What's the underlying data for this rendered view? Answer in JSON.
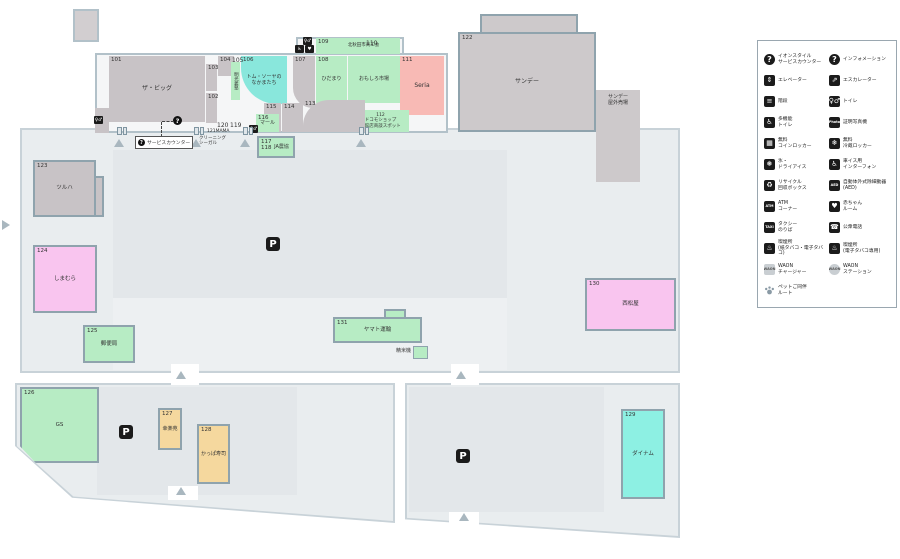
{
  "colors": {
    "parcel": "#e9edef",
    "parking_lot": "#e3e7ea",
    "building_wall": "#b2c1c9",
    "mint": "#b7ecc4",
    "cyan": "#89e7dc",
    "salmon": "#f8bab5",
    "pink": "#f9c5ef",
    "tan": "#f5d89e",
    "gray": "#cdc9cb",
    "icon_black": "#1b1b1b"
  },
  "map": {
    "service_counter": {
      "icon": "?",
      "label": "サービスカウンター"
    },
    "stores": [
      {
        "num": "101",
        "name": "ザ・ビッグ",
        "color": "graystore",
        "x": 109,
        "y": 56,
        "w": 96,
        "h": 66,
        "name_size": 6
      },
      {
        "num": "104",
        "color": "graystore",
        "x": 218,
        "y": 56,
        "w": 16,
        "h": 20
      },
      {
        "num": "103",
        "color": "graystore",
        "x": 206,
        "y": 64,
        "w": 11,
        "h": 27
      },
      {
        "num": "102",
        "color": "graystore",
        "x": 206,
        "y": 93,
        "w": 11,
        "h": 30
      },
      {
        "name": "明光義塾",
        "color": "mint",
        "x": 231,
        "y": 62,
        "w": 9,
        "h": 38,
        "vertical": true,
        "name_size": 4.5
      },
      {
        "num": "106",
        "name": "トム・ソーヤの\nなかまたち",
        "color": "cyan",
        "x": 241,
        "y": 56,
        "w": 46,
        "h": 48,
        "r": "0 0 0 36px",
        "name_size": 5
      },
      {
        "num": "107",
        "color": "graystore",
        "x": 293,
        "y": 56,
        "w": 22,
        "h": 52,
        "r": "0 0 0 20px"
      },
      {
        "num": "108",
        "name": "ひだまり",
        "color": "mint",
        "x": 316,
        "y": 56,
        "w": 31,
        "h": 47,
        "name_size": 5
      },
      {
        "num": "109",
        "name": "北秋田市商工会",
        "color": "mint",
        "x": 316,
        "y": 38,
        "w": 84,
        "h": 16,
        "row": true,
        "name_size": 4.5
      },
      {
        "name": "おもしろ市場",
        "color": "mint",
        "x": 348,
        "y": 56,
        "w": 52,
        "h": 47,
        "name_size": 5
      },
      {
        "num": "111",
        "name": "Seria",
        "color": "salmon",
        "x": 400,
        "y": 56,
        "w": 44,
        "h": 59,
        "name_size": 6
      },
      {
        "name": "112\nドコモショップ\n大館店商談スポット",
        "color": "mint",
        "x": 352,
        "y": 110,
        "w": 57,
        "h": 22,
        "name_size": 4.5
      },
      {
        "num": "113",
        "color": "graystore",
        "x": 303,
        "y": 100,
        "w": 62,
        "h": 32,
        "r": "26px 0 0 0"
      },
      {
        "num": "114",
        "color": "graystore",
        "x": 282,
        "y": 103,
        "w": 21,
        "h": 29
      },
      {
        "num": "115",
        "color": "graystore",
        "x": 264,
        "y": 103,
        "w": 17,
        "h": 29
      },
      {
        "num": "116",
        "name": "マール",
        "color": "mint",
        "x": 256,
        "y": 114,
        "w": 23,
        "h": 18,
        "name_size": 5
      },
      {
        "num": "117\n118",
        "name": "JA農協",
        "color": "mint",
        "x": 257,
        "y": 136,
        "w": 38,
        "h": 22,
        "bordered": true,
        "row": true,
        "name_size": 5
      },
      {
        "num": "122",
        "name": "サンデー",
        "color": "gray",
        "x": 458,
        "y": 32,
        "w": 138,
        "h": 100,
        "bordered": true,
        "name_size": 6
      },
      {
        "name": "サンデー\n屋外売場",
        "color": "gray",
        "x": 596,
        "y": 90,
        "w": 44,
        "h": 92,
        "name_top": true,
        "name_size": 5
      },
      {
        "num": "123",
        "name": "ツルハ",
        "color": "graystore",
        "x": 33,
        "y": 160,
        "w": 63,
        "h": 57,
        "bordered": true,
        "name_size": 5.5
      },
      {
        "num": "124",
        "name": "しまむら",
        "color": "pink",
        "x": 33,
        "y": 245,
        "w": 64,
        "h": 68,
        "bordered": true,
        "name_size": 5.5
      },
      {
        "num": "125",
        "name": "郵便局",
        "color": "mint",
        "x": 83,
        "y": 325,
        "w": 52,
        "h": 38,
        "bordered": true,
        "name_size": 5.5
      },
      {
        "num": "126",
        "name": "GS",
        "color": "mint",
        "x": 20,
        "y": 387,
        "w": 79,
        "h": 76,
        "bordered": true,
        "clip": "polygon(0 0,100% 0,100% 100%,20% 100%,0 78%)",
        "name_size": 5.5
      },
      {
        "num": "127",
        "name": "幸楽苑",
        "color": "tan",
        "x": 158,
        "y": 408,
        "w": 24,
        "h": 42,
        "bordered": true,
        "name_size": 5
      },
      {
        "num": "128",
        "name": "かっぱ寿司",
        "color": "tan",
        "x": 197,
        "y": 424,
        "w": 33,
        "h": 60,
        "bordered": true,
        "name_size": 5
      },
      {
        "num": "129",
        "name": "ダイナム",
        "color": "cyan2",
        "x": 621,
        "y": 409,
        "w": 44,
        "h": 90,
        "bordered": true,
        "name_size": 5.5
      },
      {
        "num": "130",
        "name": "西松屋",
        "color": "pink",
        "x": 585,
        "y": 278,
        "w": 91,
        "h": 53,
        "bordered": true,
        "name_size": 5.5
      },
      {
        "num": "131",
        "name": "ヤマト運輸",
        "color": "mint",
        "x": 333,
        "y": 317,
        "w": 89,
        "h": 26,
        "bordered": true,
        "name_size": 5.5
      }
    ],
    "labels": [
      {
        "t": "105",
        "x": 232,
        "y": 57
      },
      {
        "t": "110",
        "x": 366,
        "y": 40
      },
      {
        "t": "120",
        "x": 217,
        "y": 122
      },
      {
        "t": "119",
        "x": 230,
        "y": 122
      },
      {
        "t": "121MAMA",
        "x": 207,
        "y": 129,
        "s": 4.5
      },
      {
        "t": "クリーニング\nシーガル",
        "x": 199,
        "y": 136,
        "s": 4.5
      },
      {
        "t": "精米機",
        "x": 396,
        "y": 348,
        "s": 5
      }
    ],
    "markers": [
      {
        "type": "p",
        "x": 266,
        "y": 237,
        "glyph": "P",
        "name": "parking-icon"
      },
      {
        "type": "p",
        "x": 119,
        "y": 425,
        "glyph": "P",
        "name": "parking-icon"
      },
      {
        "type": "p",
        "x": 456,
        "y": 449,
        "glyph": "P",
        "name": "parking-icon"
      },
      {
        "type": "icon",
        "x": 249,
        "y": 125,
        "glyph": "♀♂",
        "name": "restroom-icon"
      },
      {
        "type": "icon",
        "x": 303,
        "y": 37,
        "glyph": "♀♂",
        "name": "restroom-icon"
      },
      {
        "type": "icon",
        "x": 295,
        "y": 45,
        "glyph": "♿",
        "name": "accessible-restroom-icon"
      },
      {
        "type": "icon",
        "x": 305,
        "y": 45,
        "glyph": "♥",
        "name": "baby-room-icon"
      },
      {
        "type": "icon",
        "x": 94,
        "y": 116,
        "glyph": "♀♂",
        "name": "restroom-icon"
      },
      {
        "type": "q",
        "x": 173,
        "y": 116,
        "glyph": "?",
        "name": "service-counter-icon"
      },
      {
        "type": "door",
        "x": 117,
        "y": 127,
        "name": "entrance-door-icon"
      },
      {
        "type": "door",
        "x": 194,
        "y": 127,
        "name": "entrance-door-icon"
      },
      {
        "type": "door",
        "x": 243,
        "y": 127,
        "name": "entrance-door-icon"
      },
      {
        "type": "door",
        "x": 359,
        "y": 127,
        "name": "entrance-door-icon"
      },
      {
        "type": "tri",
        "x": 114,
        "y": 139,
        "name": "entrance-arrow-icon"
      },
      {
        "type": "tri",
        "x": 191,
        "y": 139,
        "name": "entrance-arrow-icon"
      },
      {
        "type": "tri",
        "x": 240,
        "y": 139,
        "name": "entrance-arrow-icon"
      },
      {
        "type": "tri",
        "x": 356,
        "y": 139,
        "name": "entrance-arrow-icon"
      },
      {
        "type": "tri",
        "x": 176,
        "y": 371,
        "name": "site-entrance-arrow-icon"
      },
      {
        "type": "tri",
        "x": 456,
        "y": 371,
        "name": "site-entrance-arrow-icon"
      },
      {
        "type": "tri",
        "x": 176,
        "y": 487,
        "name": "site-entrance-arrow-icon"
      },
      {
        "type": "tri",
        "x": 459,
        "y": 513,
        "name": "site-entrance-arrow-icon"
      },
      {
        "type": "tri-right",
        "x": 2,
        "y": 220,
        "name": "site-entrance-arrow-icon"
      },
      {
        "type": "sq-mint",
        "x": 413,
        "y": 346,
        "w": 15,
        "h": 13,
        "name": "rice-mill-block"
      }
    ]
  },
  "legend": {
    "items": [
      {
        "type": "qcircle",
        "glyph": "?",
        "label": "イオンスタイル\nサービスカウンター",
        "name": "service-counter-icon"
      },
      {
        "type": "qcircle",
        "glyph": "?",
        "label": "インフォメーション",
        "name": "information-icon"
      },
      {
        "type": "sq",
        "glyph": "⇕",
        "label": "エレベーター",
        "name": "elevator-icon"
      },
      {
        "type": "sq",
        "glyph": "⇗",
        "label": "エスカレーター",
        "name": "escalator-icon"
      },
      {
        "type": "sq",
        "glyph": "≡",
        "label": "階段",
        "name": "stairs-icon"
      },
      {
        "type": "sq",
        "glyph": "♀♂",
        "label": "トイレ",
        "name": "toilet-icon"
      },
      {
        "type": "sq",
        "glyph": "♿",
        "label": "多機能\nトイレ",
        "name": "accessible-toilet-icon"
      },
      {
        "type": "sq",
        "glyph": "Photo",
        "small": true,
        "label": "証明写真機",
        "name": "photo-booth-icon"
      },
      {
        "type": "sq",
        "glyph": "▦",
        "label": "無料\nコインロッカー",
        "name": "coin-locker-icon"
      },
      {
        "type": "sq",
        "glyph": "❄",
        "label": "無料\n冷蔵ロッカー",
        "name": "cold-locker-icon"
      },
      {
        "type": "sq",
        "glyph": "❅",
        "label": "氷・\nドライアイス",
        "name": "ice-icon"
      },
      {
        "type": "sq",
        "glyph": "♿",
        "label": "車イス用\nインターフォン",
        "name": "wheelchair-intercom-icon"
      },
      {
        "type": "sq",
        "glyph": "♻",
        "label": "リサイクル\n回収ボックス",
        "name": "recycle-box-icon"
      },
      {
        "type": "sq",
        "glyph": "AED",
        "small": true,
        "label": "自動体外式除細動器\n(AED)",
        "name": "aed-icon"
      },
      {
        "type": "sq",
        "glyph": "ATM",
        "small": true,
        "label": "ATM\nコーナー",
        "name": "atm-icon"
      },
      {
        "type": "sq",
        "glyph": "♥",
        "label": "赤ちゃん\nルーム",
        "name": "baby-room-icon"
      },
      {
        "type": "sq",
        "glyph": "TAXI",
        "small": true,
        "label": "タクシー\nのりば",
        "name": "taxi-icon"
      },
      {
        "type": "sq",
        "glyph": "☎",
        "label": "公衆電話",
        "name": "public-phone-icon"
      },
      {
        "type": "sq",
        "glyph": "♨",
        "label": "喫煙所\n(紙タバコ・電子タバコ)",
        "name": "smoking-area-icon"
      },
      {
        "type": "sq",
        "glyph": "♨",
        "label": "喫煙所\n(電子タバコ専用)",
        "name": "e-smoking-area-icon"
      },
      {
        "type": "sqlight",
        "glyph": "WAON",
        "small": true,
        "label": "WAON\nチャージャー",
        "name": "waon-charger-icon"
      },
      {
        "type": "circlight",
        "glyph": "WAON",
        "small": true,
        "label": "WAON\nステーション",
        "name": "waon-station-icon"
      },
      {
        "type": "paw",
        "glyph": "",
        "label": "ペットご同伴\nルート",
        "name": "pet-route-icon"
      }
    ]
  }
}
